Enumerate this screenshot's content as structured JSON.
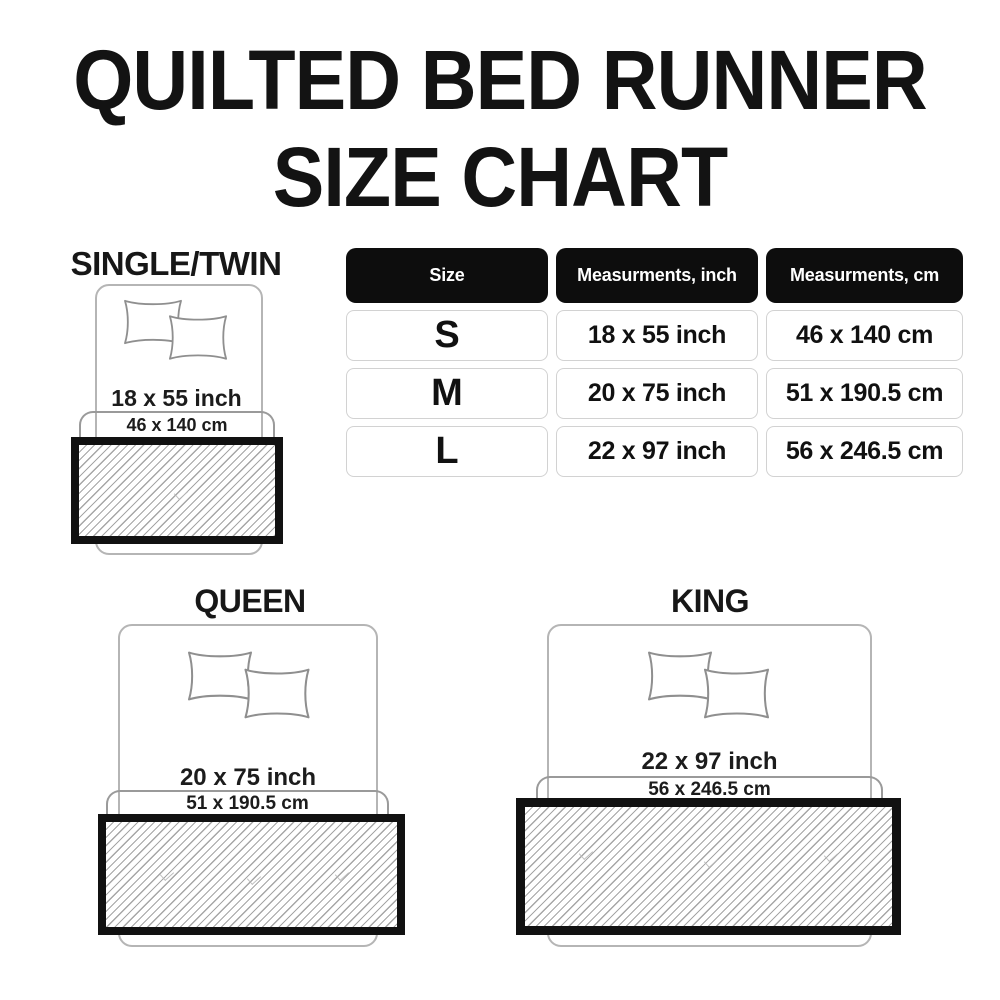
{
  "title": {
    "line1": "QUILTED BED RUNNER",
    "line2": "SIZE CHART"
  },
  "table": {
    "headers": [
      "Size",
      "Measurments, inch",
      "Measurments, cm"
    ],
    "rows": [
      {
        "size": "S",
        "inch": "18 x 55 inch",
        "cm": "46 x 140 cm"
      },
      {
        "size": "M",
        "inch": "20 x 75 inch",
        "cm": "51 x 190.5 cm"
      },
      {
        "size": "L",
        "inch": "22 x 97 inch",
        "cm": "56 x 246.5 cm"
      }
    ]
  },
  "diagrams": [
    {
      "label": "SINGLE/TWIN",
      "inch": "18 x 55 inch",
      "cm": "46 x 140 cm"
    },
    {
      "label": "QUEEN",
      "inch": "20 x 75 inch",
      "cm": "51 x 190.5 cm"
    },
    {
      "label": "KING",
      "inch": "22 x 97 inch",
      "cm": "56 x 246.5 cm"
    }
  ],
  "colors": {
    "text": "#131313",
    "header_bg": "#0d0d0d",
    "header_text": "#ffffff",
    "cell_border": "#d2d2d2",
    "bed_outline": "#b5b5b5",
    "bracket": "#9a9a9a",
    "runner_border": "#111111",
    "hatch_line": "#a6a6a6",
    "background": "#ffffff"
  }
}
